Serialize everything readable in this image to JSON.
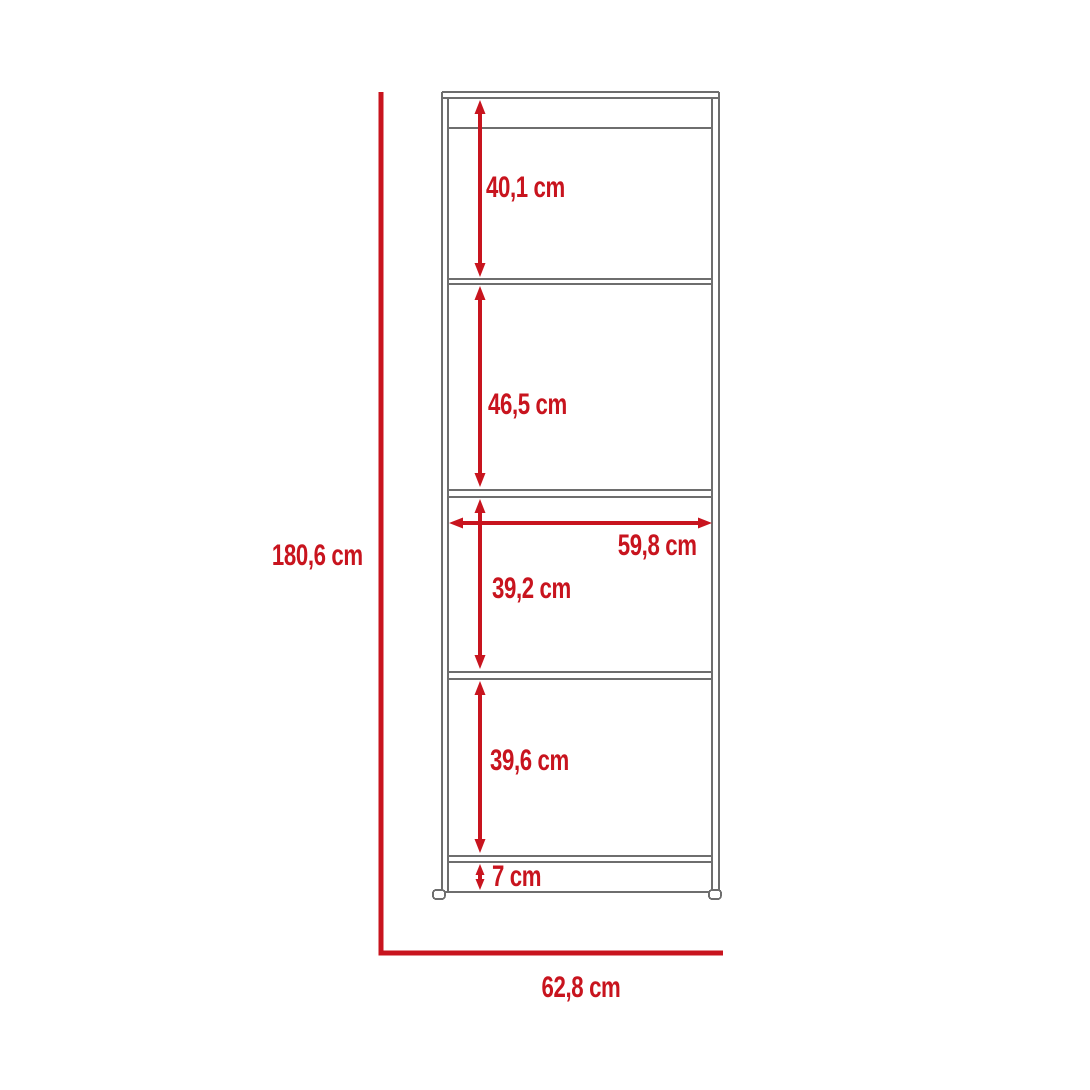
{
  "diagram": {
    "type": "furniture-dimension-diagram",
    "product": "5-tier bookcase / shelving unit",
    "unit": "cm",
    "colors": {
      "dimension_red": "#C8141E",
      "outline_gray": "#6E6E6E",
      "background": "#FFFFFF"
    },
    "labels": {
      "total_height": "180,6 cm",
      "total_width": "62,8 cm",
      "interior_width": "59,8 cm",
      "section_1": "40,1 cm",
      "section_2": "46,5 cm",
      "section_3": "39,2 cm",
      "section_4": "39,6 cm",
      "base_height": "7 cm"
    },
    "sections_top_to_bottom": [
      "40,1 cm",
      "46,5 cm",
      "39,2 cm",
      "39,6 cm",
      "7 cm"
    ]
  }
}
